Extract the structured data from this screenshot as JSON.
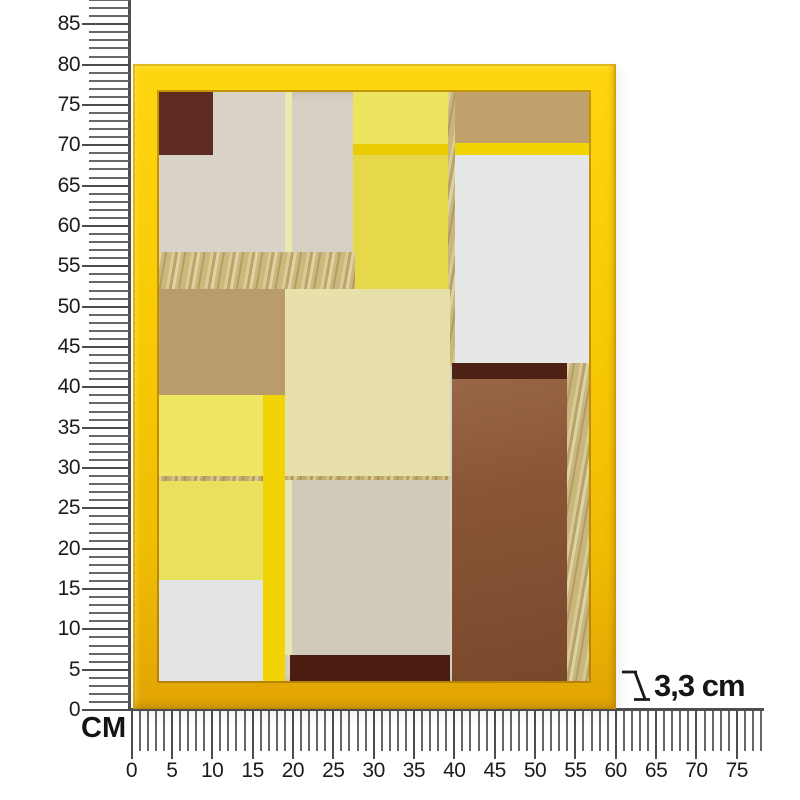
{
  "scene": {
    "background": "#ffffff",
    "depth_label": "3,3 cm",
    "unit_label": "CM"
  },
  "vertical_ruler": {
    "labels": [
      "0",
      "5",
      "10",
      "15",
      "20",
      "25",
      "30",
      "35",
      "40",
      "45",
      "50",
      "55",
      "60",
      "65",
      "70",
      "75",
      "80",
      "85"
    ],
    "label_step_cm": 5,
    "tick_min_cm": 0,
    "tick_max_cm": 88
  },
  "horizontal_ruler": {
    "labels": [
      "0",
      "5",
      "10",
      "15",
      "20",
      "25",
      "30",
      "35",
      "40",
      "45",
      "50",
      "55",
      "60",
      "65",
      "70",
      "75"
    ],
    "label_step_cm": 5,
    "tick_min_cm": 0,
    "tick_max_cm": 78
  },
  "frame": {
    "color": "#f5c806",
    "edge_dark": "#d9a404",
    "highlight": "#ffd60f"
  },
  "artwork": {
    "background": "#d6cfc3",
    "blocks": [
      {
        "n": "beige-col-left",
        "x": 0,
        "y": 0,
        "w": 126,
        "h": 160,
        "c": "#d9d2c6"
      },
      {
        "n": "pale-stripe-top",
        "x": 126,
        "y": 0,
        "w": 7,
        "h": 160,
        "c": "#ebe9ae"
      },
      {
        "n": "brown-square-top-left",
        "x": 0,
        "y": 0,
        "w": 54,
        "h": 63,
        "c": "#5e2b23"
      },
      {
        "n": "yellow-top-mid",
        "x": 194,
        "y": 0,
        "w": 97,
        "h": 52,
        "c": "#ece45f"
      },
      {
        "n": "yellow-stripe-mid",
        "x": 194,
        "y": 52,
        "w": 97,
        "h": 11,
        "c": "#ebcb02"
      },
      {
        "n": "yellow-mid",
        "x": 194,
        "y": 63,
        "w": 97,
        "h": 134,
        "c": "#e7d74b"
      },
      {
        "n": "tan-top-right",
        "x": 296,
        "y": 0,
        "w": 134,
        "h": 51,
        "c": "#c1a26d"
      },
      {
        "n": "yellow-stripe-right",
        "x": 296,
        "y": 51,
        "w": 134,
        "h": 12,
        "c": "#f1d404"
      },
      {
        "n": "white-right",
        "x": 296,
        "y": 63,
        "w": 134,
        "h": 211,
        "c": "#e5e8e7"
      },
      {
        "n": "gold-line-vertical",
        "x": 289,
        "y": 0,
        "w": 7,
        "h": 274,
        "c": "#c9b67c",
        "t": "gold"
      },
      {
        "n": "gold-band",
        "x": 0,
        "y": 160,
        "w": 196,
        "h": 37,
        "c": "#cbb87e",
        "t": "gold"
      },
      {
        "n": "tan-square-left",
        "x": 0,
        "y": 197,
        "w": 126,
        "h": 106,
        "c": "#ba9c6b"
      },
      {
        "n": "cream-center",
        "x": 126,
        "y": 197,
        "w": 165,
        "h": 191,
        "c": "#e7e0aa"
      },
      {
        "n": "yellow-left-upper",
        "x": 0,
        "y": 303,
        "w": 104,
        "h": 81,
        "c": "#efe763"
      },
      {
        "n": "gold-line-horizontal",
        "x": 0,
        "y": 384,
        "w": 291,
        "h": 5,
        "c": "#c2ab6d",
        "t": "gold"
      },
      {
        "n": "yellow-left-lower",
        "x": 0,
        "y": 389,
        "w": 104,
        "h": 99,
        "c": "#ebe05e"
      },
      {
        "n": "white-bottom-left",
        "x": 0,
        "y": 488,
        "w": 104,
        "h": 101,
        "c": "#e1e4e3"
      },
      {
        "n": "yellow-stripe-vertical",
        "x": 104,
        "y": 303,
        "w": 22,
        "h": 286,
        "c": "#f2d406"
      },
      {
        "n": "pale-stripe-bottom",
        "x": 126,
        "y": 388,
        "w": 7,
        "h": 175,
        "c": "#e9e6b4"
      },
      {
        "n": "greige-center",
        "x": 133,
        "y": 388,
        "w": 158,
        "h": 175,
        "c": "#d1c9bc"
      },
      {
        "n": "maroon-strip-bottom",
        "x": 131,
        "y": 563,
        "w": 160,
        "h": 26,
        "c": "#4b1d10"
      },
      {
        "n": "brown-block-right",
        "x": 293,
        "y": 271,
        "w": 115,
        "h": 318,
        "c": "#8a5536",
        "t": "brown"
      },
      {
        "n": "maroon-strip-right",
        "x": 293,
        "y": 271,
        "w": 115,
        "h": 16,
        "c": "#4e2115"
      },
      {
        "n": "gold-strip-right",
        "x": 408,
        "y": 271,
        "w": 22,
        "h": 318,
        "c": "#c9b67d",
        "t": "gold"
      }
    ]
  }
}
